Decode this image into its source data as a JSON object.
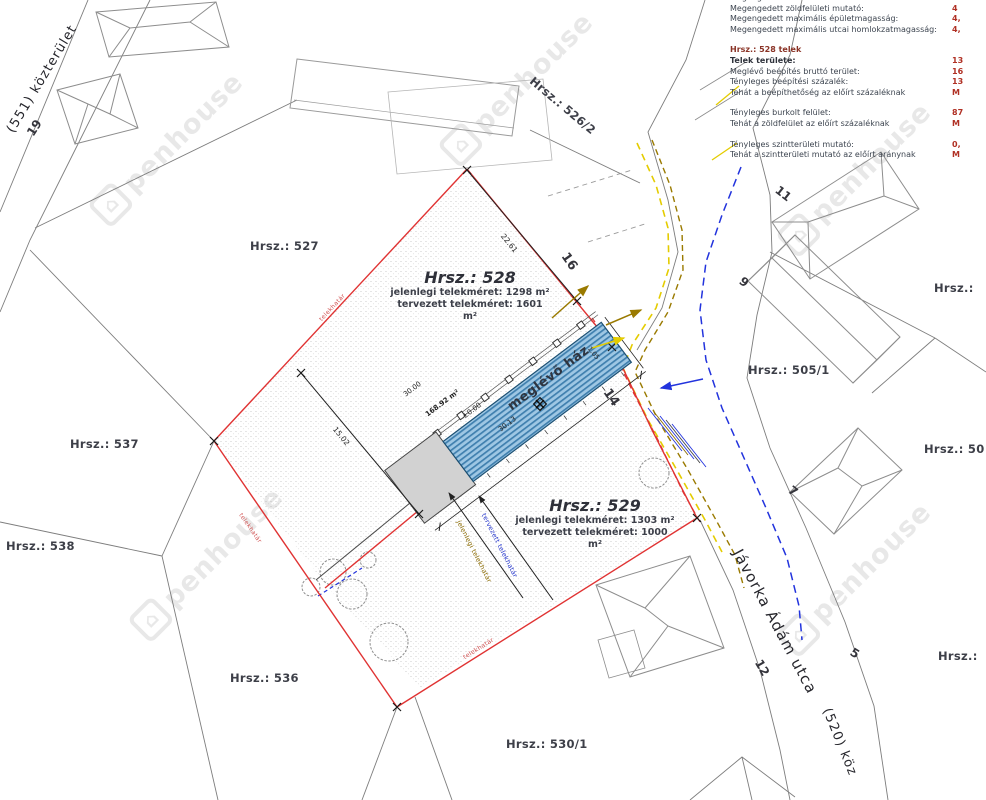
{
  "info_panel": {
    "rows": [
      {
        "label": "Megengedett szintterületi mutató:",
        "value": ""
      },
      {
        "label": "Megengedett zöldfelületi mutató:",
        "value": "4"
      },
      {
        "label": "Megengedett maximális épületmagasság:",
        "value": "4,"
      },
      {
        "label": "Megengedett maximális utcai homlokzatmagasság:",
        "value": "4,"
      },
      {
        "label": "Hrsz.: 528 telek",
        "value": ""
      },
      {
        "label": "Telek területe:",
        "value": "13"
      },
      {
        "label": "Meglévő beépítés bruttó terület:",
        "value": "16"
      },
      {
        "label": "Tényleges beépítési százalék:",
        "value": "13"
      },
      {
        "label": "Tehát a beépíthetőség az előírt százaléknak",
        "value": "M"
      },
      {
        "label": "Tényleges burkolt felület:",
        "value": "87"
      },
      {
        "label": "Tehát a zöldfelület az előírt százaléknak",
        "value": "M"
      },
      {
        "label": "Tényleges szintterületi mutató:",
        "value": "0,"
      },
      {
        "label": "Tehát a szintterületi mutató az előírt aránynak",
        "value": "M"
      }
    ]
  },
  "parcels": {
    "p527": "Hrsz.: 527",
    "p526_2": "Hrsz.: 526/2",
    "p505_1": "Hrsz.: 505/1",
    "p537": "Hrsz.: 537",
    "p538": "Hrsz.: 538",
    "p536": "Hrsz.: 536",
    "p530_1": "Hrsz.: 530/1",
    "edge_right_top": "Hrsz.:",
    "edge_right_mid": "Hrsz.: 50",
    "edge_right_bottom": "Hrsz.:"
  },
  "site": {
    "p528": {
      "title": "Hrsz.: 528",
      "line1": "jelenlegi telekméret: 1298 m²",
      "line2": "tervezett telekméret: 1601 m²"
    },
    "p529": {
      "title": "Hrsz.: 529",
      "line1": "jelenlegi telekméret: 1303 m²",
      "line2": "tervezett telekméret: 1000 m²"
    },
    "building_label": "meglévő ház",
    "building_area": "168.92 m²",
    "level": "±0.00"
  },
  "dimensions": {
    "d_ne": "22.61",
    "d_w": "15.02",
    "d_house": "30.13",
    "d_house_plan": "30.00",
    "d_gap": "1.05"
  },
  "house_numbers": {
    "n16": "16",
    "n14": "14",
    "n19": "19",
    "n12": "12",
    "n11": "11",
    "n9": "9",
    "n7": "7",
    "n5": "5"
  },
  "streets": {
    "javorka": "Jávorka Ádám utca",
    "s551": "(551) közterület",
    "s520": "(520) köz"
  },
  "annotations": {
    "existing_boundary": "jelenlegi telekhatár",
    "planned_boundary": "tervezett telekhatár",
    "boundary": "telekhatár"
  },
  "watermark": {
    "icon": "⌂",
    "text": "penhouse"
  },
  "colors": {
    "boundary_red": "#e03333",
    "hatch_blue": "#3f7fae",
    "dash_yellow": "#e4cc00",
    "dash_olive": "#9a7a00",
    "dash_blue": "#2233dd",
    "value_red": "#b03024"
  }
}
